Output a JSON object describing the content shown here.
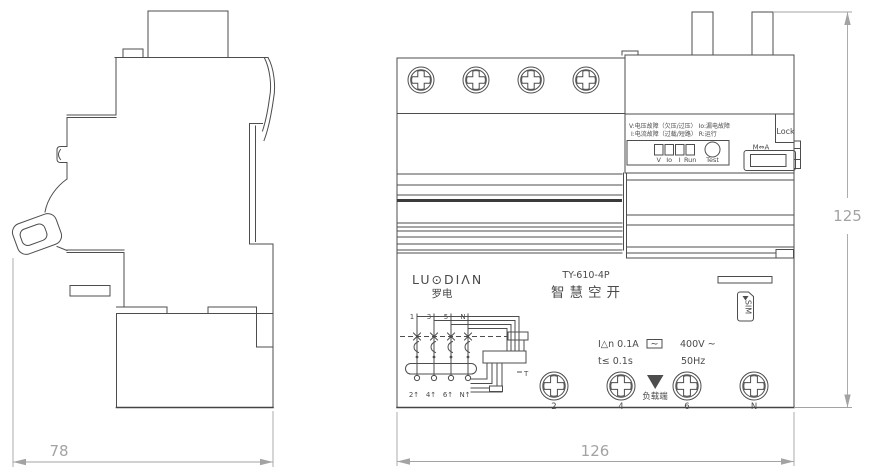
{
  "side_view": {
    "dimension_width": "78"
  },
  "front_view": {
    "brand_logo": "LU⊙DIΛN",
    "brand_cn": "罗电",
    "model": "TY-610-4P",
    "product_name": "智慧空开",
    "legend_line1": "V:电压故障（欠压/过压） Io:漏电故障",
    "legend_line2": "I:电流故障（过载/短路）  R:运行",
    "indicators": [
      "V",
      "Io",
      "I",
      "Run"
    ],
    "test_label": "Test",
    "lock_label": "Lock",
    "mode_switch": "M⇔A",
    "sim_label": "SIM",
    "ratings": {
      "residual_current": "I△n 0.1A",
      "wave_symbol": "~",
      "voltage": "400V ~",
      "trip_time": "t≤ 0.1s",
      "frequency": "50Hz"
    },
    "load_side_label": "负载端",
    "schematic": {
      "top_terminals": [
        "1",
        "3",
        "5",
        "N"
      ],
      "bottom_terminals": [
        "2↑",
        "4↑",
        "6↑",
        "N↑"
      ],
      "t_label": "T"
    },
    "bottom_terminal_labels": [
      "2",
      "4",
      "6",
      "N"
    ],
    "dimension_width": "126",
    "dimension_height": "125"
  }
}
